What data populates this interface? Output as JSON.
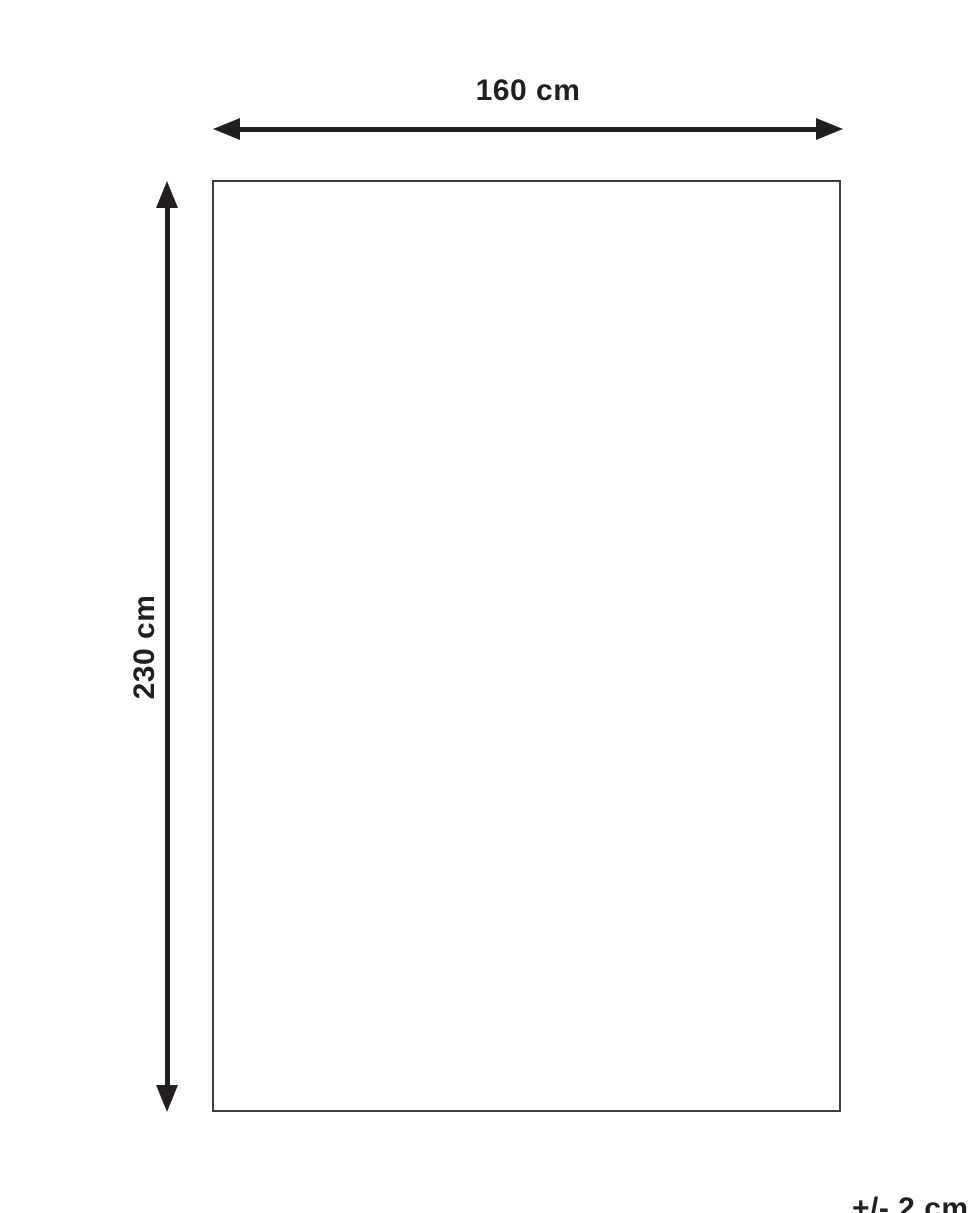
{
  "diagram": {
    "title": "product-dimension-diagram",
    "width_label": "160 cm",
    "height_label": "230 cm",
    "tolerance_label": "+/- 2 cm",
    "colors": {
      "line": "#231f20",
      "rect_border": "#3e3e3e",
      "background": "#ffffff"
    }
  }
}
